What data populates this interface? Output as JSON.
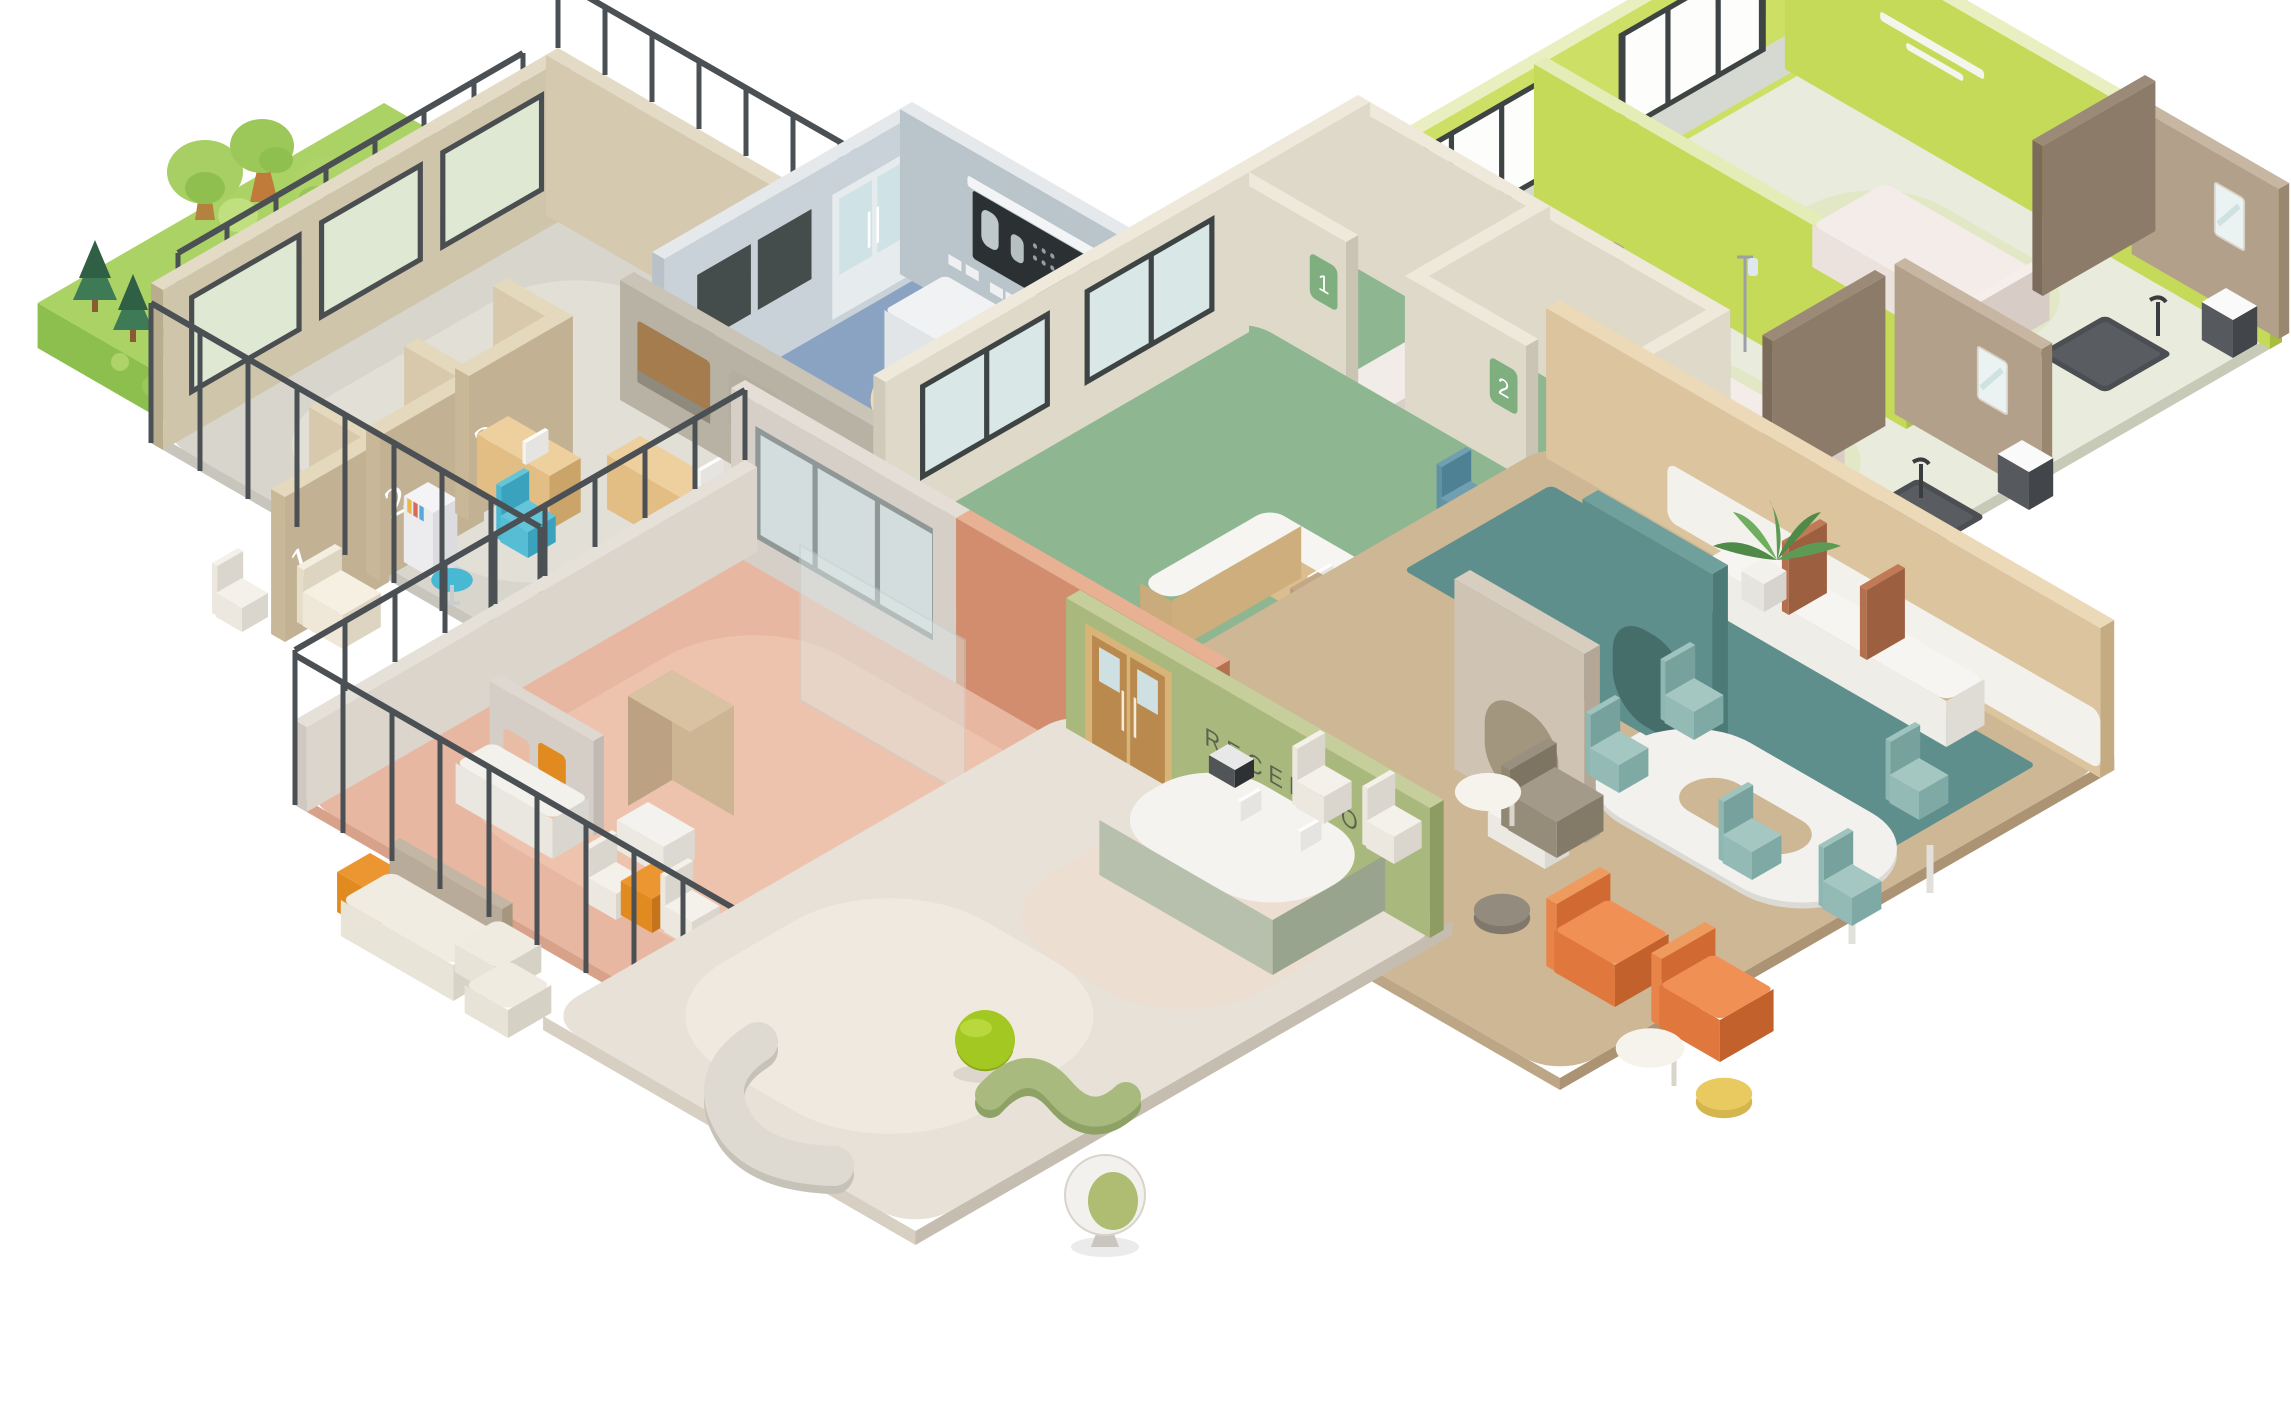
{
  "scene": {
    "type": "isometric-hospital-floor-cutaway",
    "background": "#ffffff",
    "labels": {
      "reception_sign": "RECEPTION",
      "corridor_wall_plaque": "2",
      "nurse_station_room_1_plate": "1",
      "nurse_station_room_2_plate": "2",
      "consultation_pod_1": "1",
      "consultation_pod_2": "2",
      "consultation_pod_3": "3"
    },
    "floor_icons": [
      {
        "name": "scissors-arrow-floor-icon",
        "glyph_color": "#ffffff",
        "tile_color": "#b9c6cb"
      },
      {
        "name": "bed-arrow-floor-icon",
        "glyph_color": "#ffffff",
        "tile_color": "#bcc9cd"
      },
      {
        "name": "stethoscope-arrow-floor-icon",
        "glyph_color": "#ffffff",
        "tile_color": "#c3ced1"
      }
    ],
    "rooms": [
      {
        "name": "operating-room",
        "floor": "#8ba3c2",
        "walls": "#c9d2d9"
      },
      {
        "name": "patient-ward-room-a",
        "floor": "#e9ebdd",
        "walls": "#cde065"
      },
      {
        "name": "patient-ward-room-b",
        "floor": "#e9ebdd",
        "walls": "#cde065"
      },
      {
        "name": "ensuite-bathroom-a",
        "walls": "#b2a08b",
        "shower_tray": "#4b4e52"
      },
      {
        "name": "ensuite-bathroom-b",
        "walls": "#b2a08b",
        "shower_tray": "#4b4e52"
      },
      {
        "name": "nurse-station",
        "floor": "#8eb690",
        "walls": "#ded9c9"
      },
      {
        "name": "consultation-area",
        "floor": "#d8d5cd",
        "walls": "#cfc5ab"
      },
      {
        "name": "family-lounge",
        "floor": "#e8b7a1",
        "walls": "#d28d6e"
      },
      {
        "name": "reception",
        "floor": "#e7e1d7",
        "walls": "#a9b87c"
      },
      {
        "name": "cafeteria-waiting-area",
        "floor": "#cdb795",
        "walls": "#dcc49e"
      },
      {
        "name": "garden",
        "grass": "#abd264"
      },
      {
        "name": "corridor",
        "floor": "#dde8e7"
      }
    ],
    "palette": {
      "accent_orange": "#e0773c",
      "accent_teal": "#6ec2d3",
      "accent_lime": "#c6da59",
      "accent_olive": "#a9b87c",
      "accent_salmon": "#d28d6e",
      "accent_sage": "#8eb690",
      "accent_slate_blue": "#8ba3c2",
      "wood": "#d9ba8d",
      "railing": "#4b5054",
      "equipment_white": "#f1f2f4"
    }
  }
}
